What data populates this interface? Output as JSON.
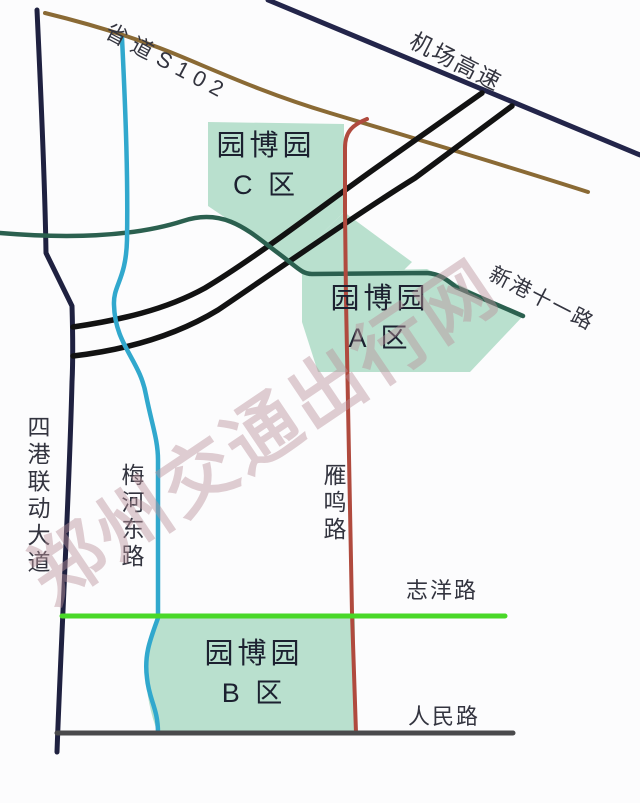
{
  "map": {
    "title": "园博园周边道路示意图",
    "watermark": "郑州交通出行网",
    "roads": {
      "s102": "省道S102",
      "airport_expressway": "机场高速",
      "xingang_11_road": "新港十一路",
      "sigang_liandong_avenue": "四港联动大道",
      "meihe_east_road": "梅河东路",
      "yanming_road": "雁鸣路",
      "zhiyang_road": "志洋路",
      "renmin_road": "人民路"
    },
    "zones": {
      "c": {
        "line1": "园博园",
        "line2": "C 区"
      },
      "a": {
        "line1": "园博园",
        "line2": "A 区"
      },
      "b": {
        "line1": "园博园",
        "line2": "B 区"
      }
    },
    "colors": {
      "navy": "#23254a",
      "navyDark": "#1f2140",
      "brown": "#8a6a35",
      "black": "#121212",
      "darkGreen": "#2b604f",
      "cyan": "#31a8cd",
      "red": "#b04a3e",
      "brightGreen": "#49d828",
      "gray": "#4a4a4c",
      "zoneFill": "#b9e0ce",
      "zoneText": "#1c2130",
      "labelText": "#33343f",
      "watermark": "rgba(187,147,155,0.45)"
    }
  }
}
